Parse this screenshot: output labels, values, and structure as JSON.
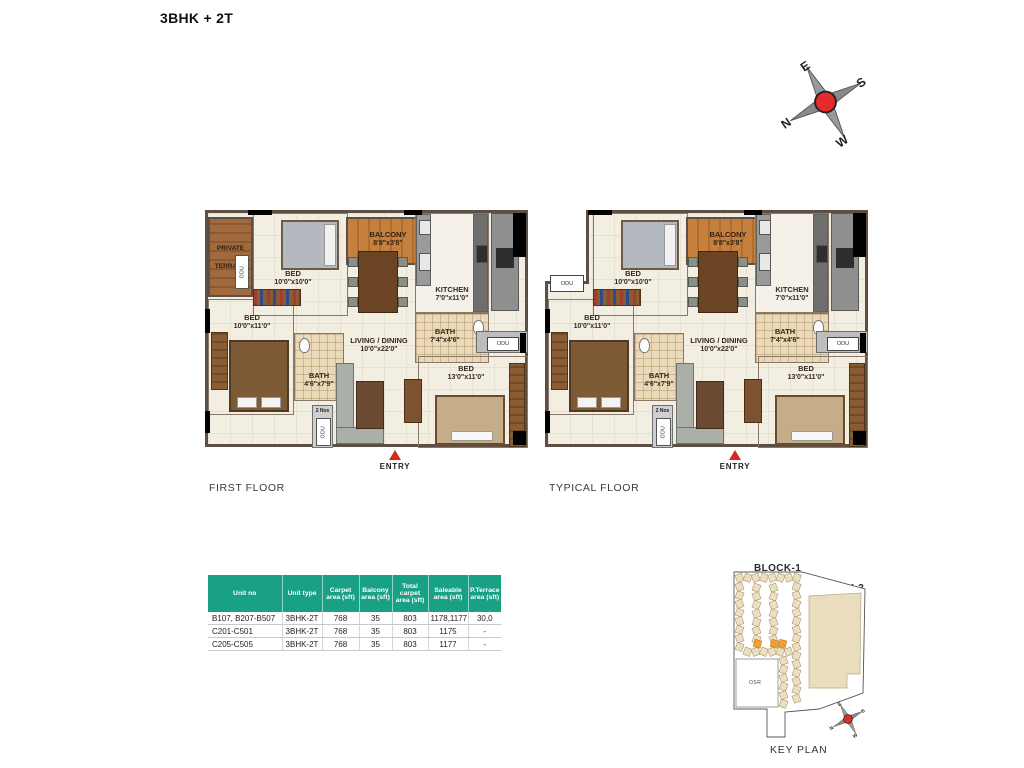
{
  "page": {
    "title": "3BHK + 2T"
  },
  "compass": {
    "n": "N",
    "e": "E",
    "s": "S",
    "w": "W"
  },
  "plans": [
    {
      "caption": "FIRST FLOOR"
    },
    {
      "caption": "TYPICAL FLOOR"
    }
  ],
  "rooms": {
    "private_terrace": {
      "name": "PRIVATE TERRACE"
    },
    "bed_top": {
      "name": "BED",
      "dims": "10'0\"x10'0\""
    },
    "balcony": {
      "name": "BALCONY",
      "dims": "8'8\"x3'8\""
    },
    "kitchen": {
      "name": "KITCHEN",
      "dims": "7'0\"x11'0\""
    },
    "bed_left": {
      "name": "BED",
      "dims": "10'0\"x11'0\""
    },
    "bath_top": {
      "name": "BATH",
      "dims": "7'4\"x4'6\""
    },
    "living_dining": {
      "name": "LIVING / DINING",
      "dims": "10'0\"x22'0\""
    },
    "bath_left": {
      "name": "BATH",
      "dims": "4'6\"x7'9\""
    },
    "bed_right": {
      "name": "BED",
      "dims": "13'0\"x11'0\""
    },
    "odu_label": "ODU",
    "two_nos_label": "2 Nos",
    "entry_label": "ENTRY"
  },
  "table": {
    "columns": [
      "Unit no",
      "Unit type",
      "Carpet area (sft)",
      "Balcony area (sft)",
      "Total carpet area (sft)",
      "Saleable area (sft)",
      "P.Terrace area (sft)"
    ],
    "rows": [
      [
        "B107, B207-B507",
        "3BHK-2T",
        "768",
        "35",
        "803",
        "1178,1177",
        "30,0"
      ],
      [
        "C201-C501",
        "3BHK-2T",
        "768",
        "35",
        "803",
        "1175",
        "-"
      ],
      [
        "C205-C505",
        "3BHK-2T",
        "768",
        "35",
        "803",
        "1177",
        "-"
      ]
    ]
  },
  "key_plan": {
    "block1": "BLOCK-1",
    "block2": "BLOCK-2",
    "osr": "OSR",
    "caption": "KEY PLAN",
    "compass": {
      "n": "N",
      "e": "E",
      "s": "S",
      "w": "W"
    }
  },
  "colors": {
    "table_header": "#18a185",
    "accent_red": "#d9291c",
    "balcony_wood": "#c5803d",
    "terrace_wood": "#a06a3e",
    "site_beige": "#ecdfc0",
    "highlight_orange": "#f0a030"
  }
}
